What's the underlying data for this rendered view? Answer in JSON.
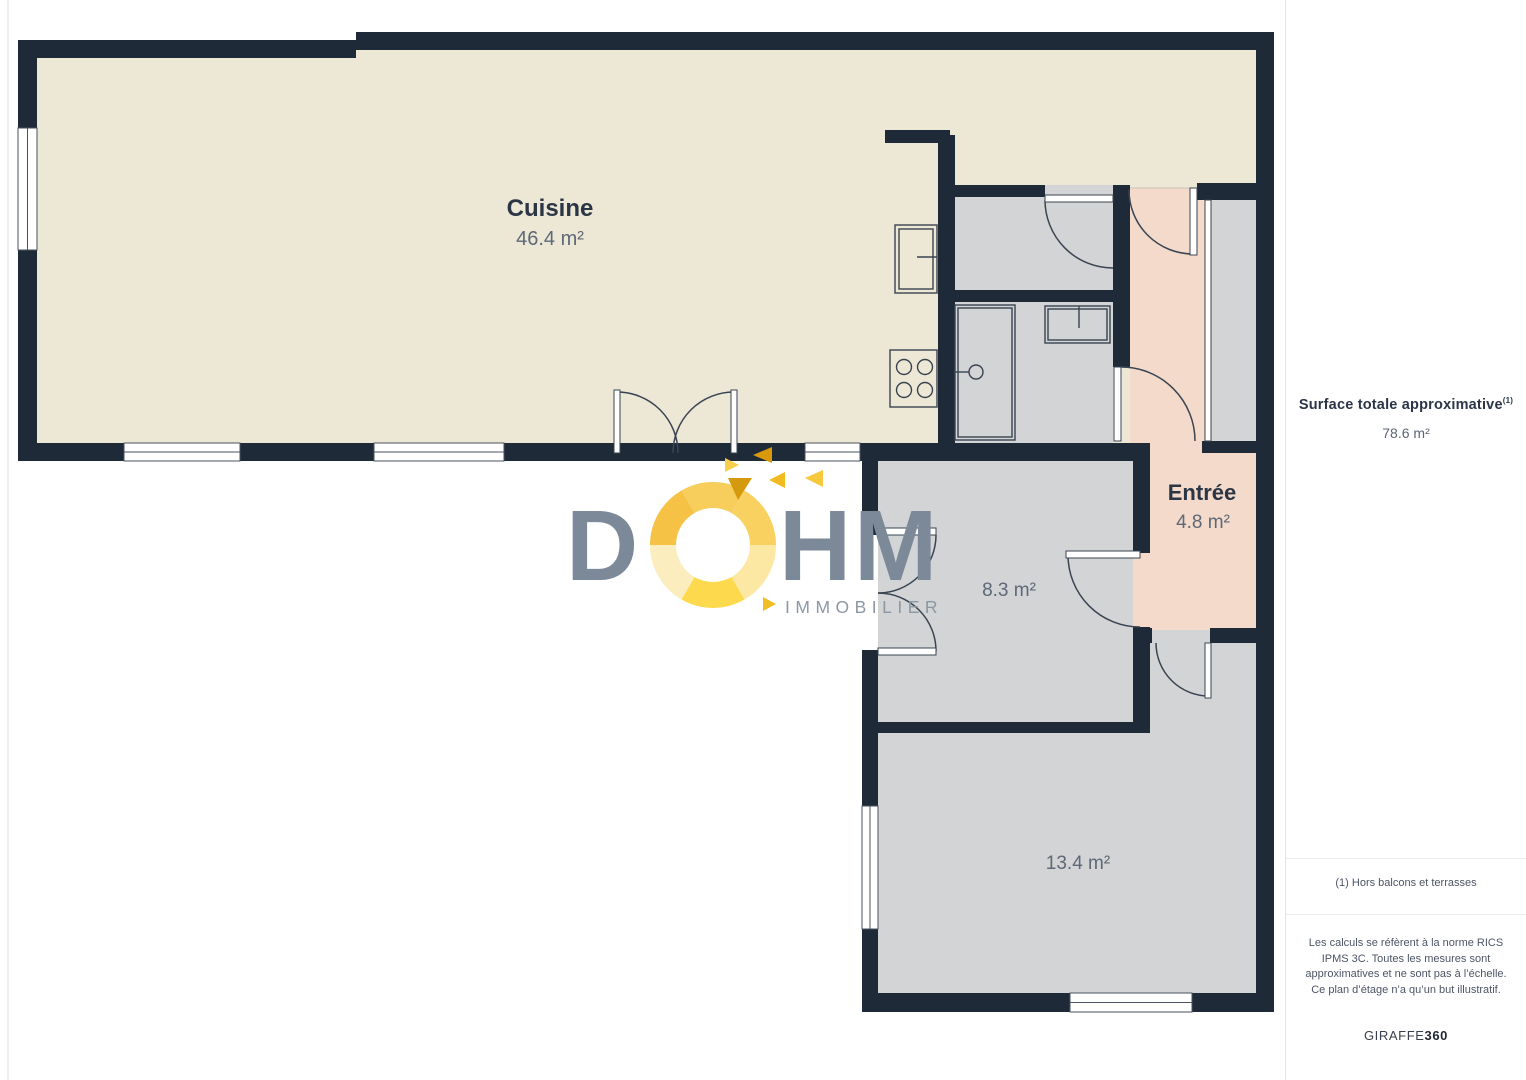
{
  "plan": {
    "rooms": [
      {
        "label": "Cuisine",
        "area": "46.4 m²"
      },
      {
        "label": "Entrée",
        "area": "4.8 m²"
      },
      {
        "label": "",
        "area": "8.3 m²"
      },
      {
        "label": "",
        "area": "13.4 m²"
      }
    ]
  },
  "logo": {
    "letter_d": "D",
    "letter_h": "H",
    "letter_m": "M",
    "subtitle": "IMMOBILIER"
  },
  "sidebar": {
    "title": "Surface totale approximative",
    "title_sup": "(1)",
    "total": "78.6 m²",
    "footnote": "(1) Hors balcons et terrasses",
    "legal": "Les calculs se réfèrent à la norme RICS IPMS 3C. Toutes les mesures sont approximatives et ne sont pas à l’échelle. Ce plan d’étage n’a qu’un but illustratif.",
    "brand_regular": "GIRAFFE",
    "brand_bold": "360"
  },
  "colors": {
    "wall": "#1F2A38",
    "kitchen_fill": "#EDE7D6",
    "entry_fill": "#F3DACA",
    "room_fill": "#D2D4D6",
    "logo_slate": "#7B8998",
    "logo_gold": "#F5C235"
  }
}
